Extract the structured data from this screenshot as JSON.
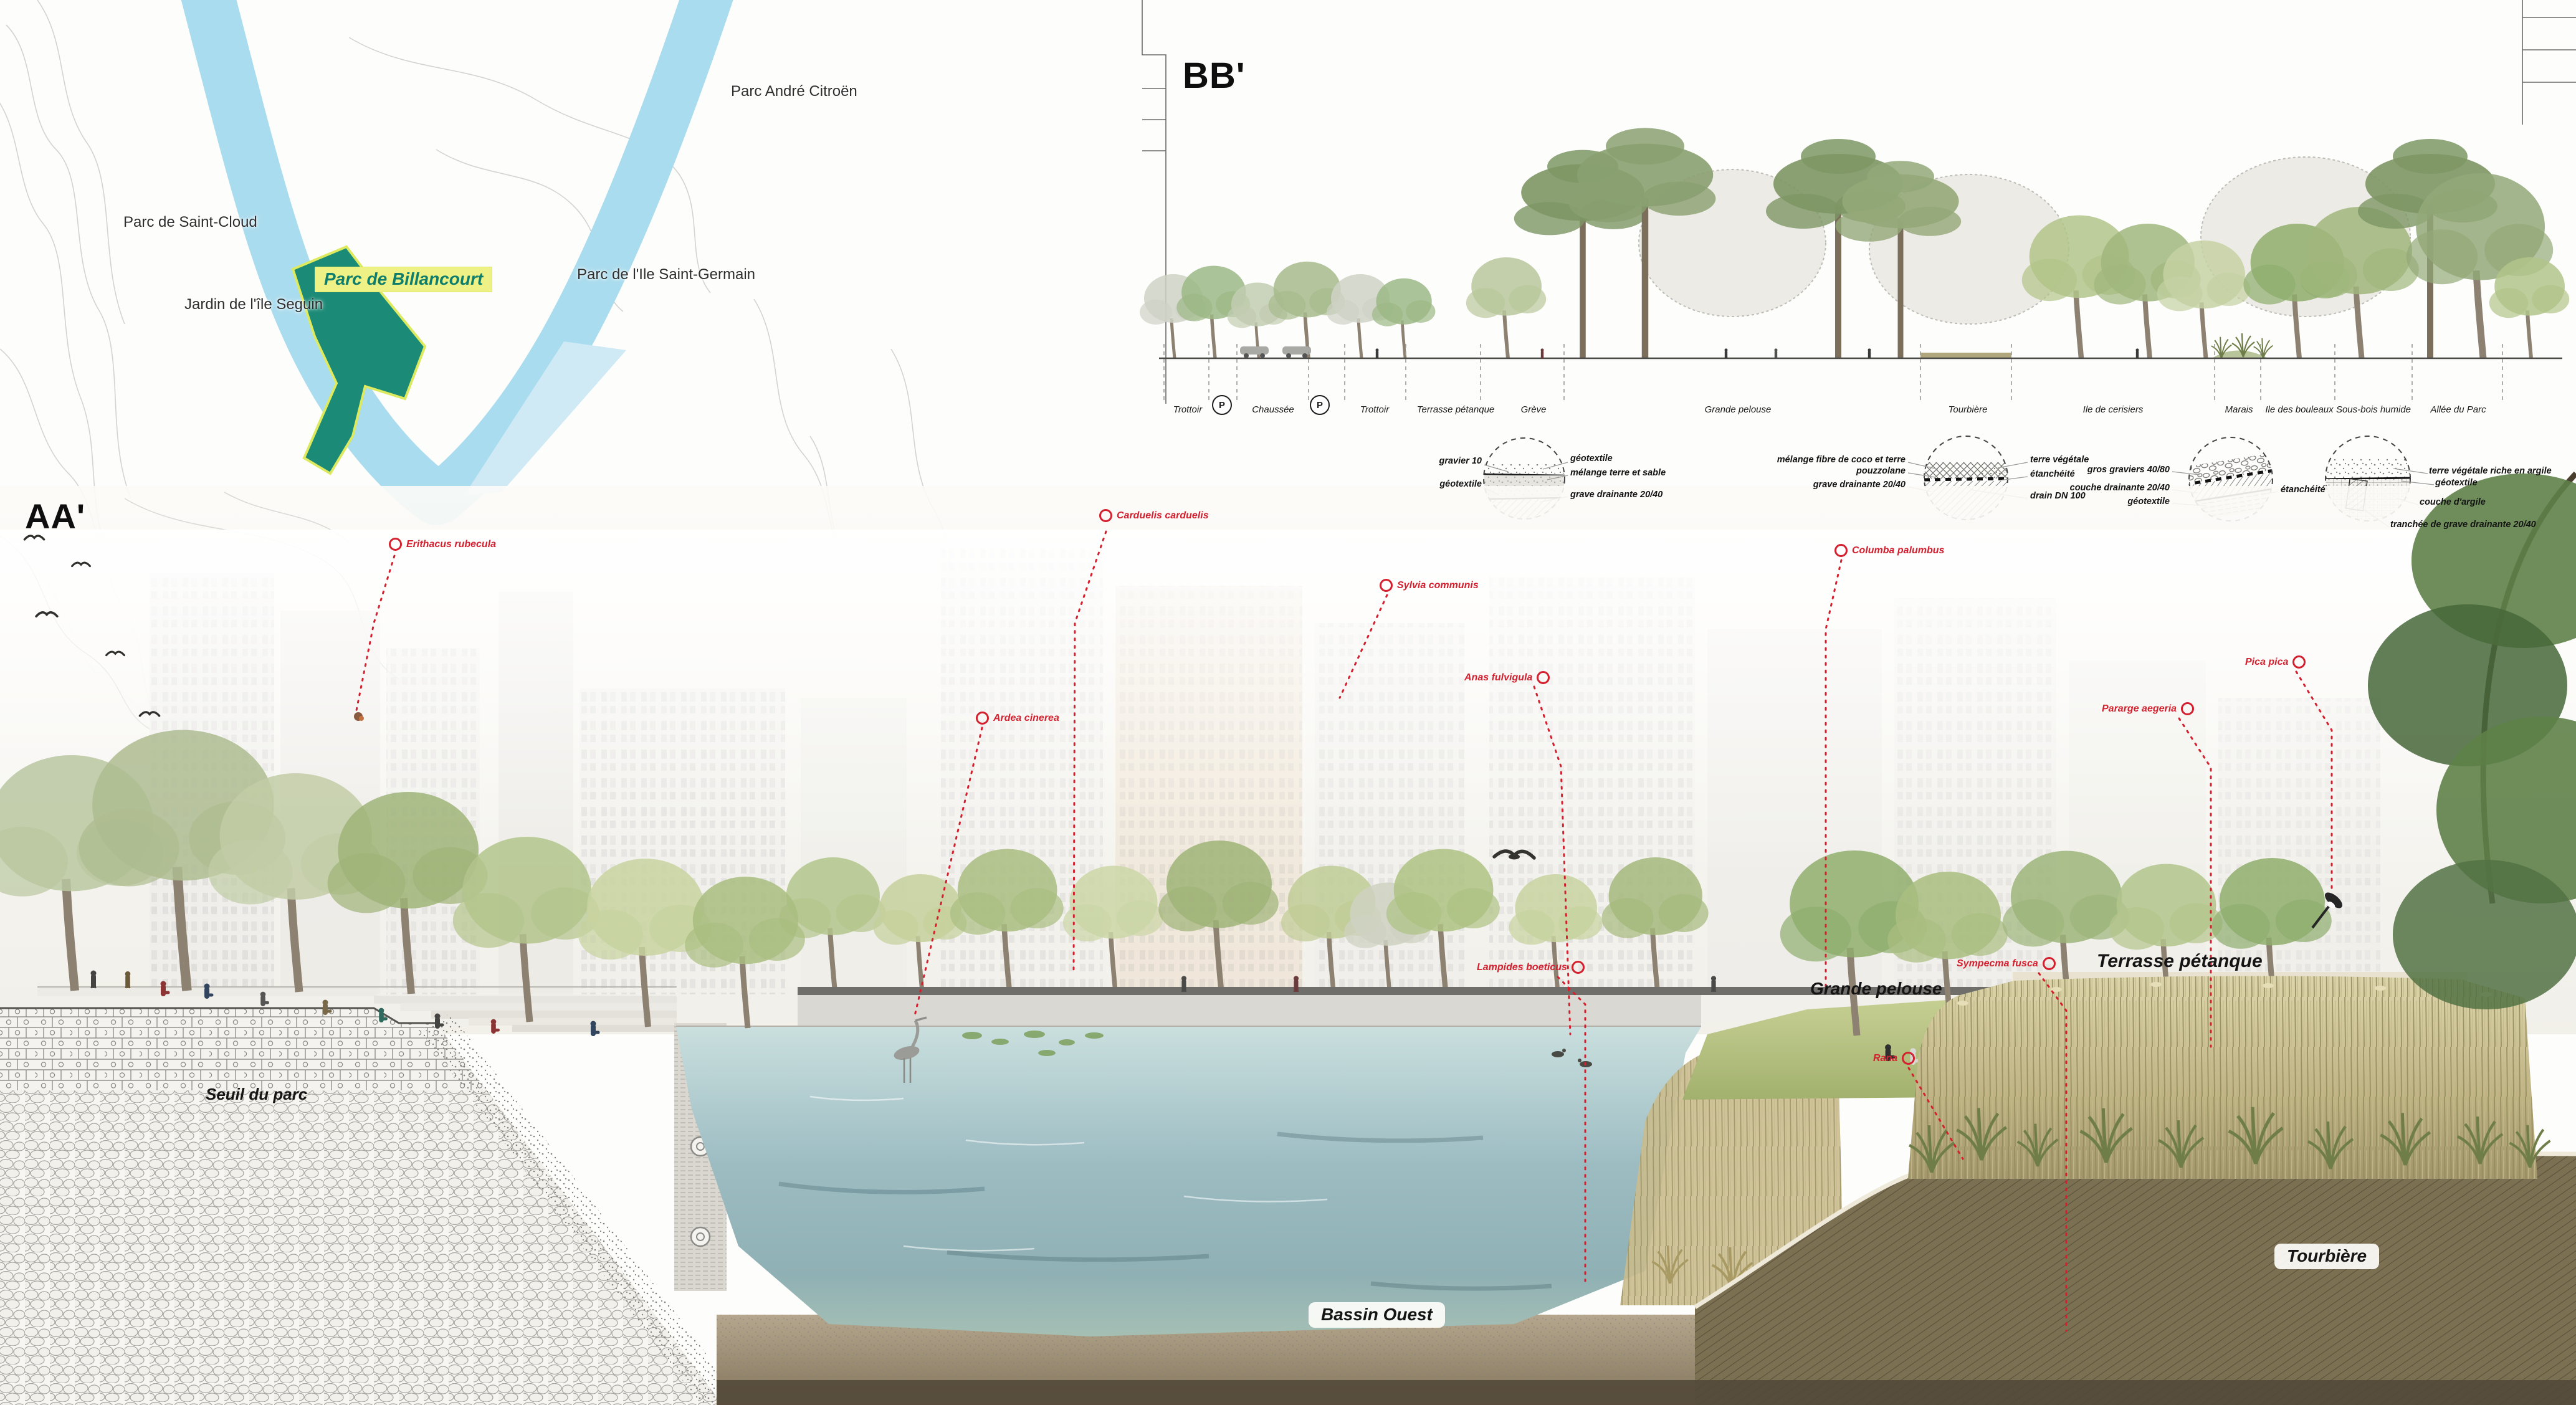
{
  "map": {
    "labels": [
      {
        "text": "Parc André Citroën"
      },
      {
        "text": "Parc de Saint-Cloud"
      },
      {
        "text": "Jardin de l'île Seguin"
      },
      {
        "text": "Parc de l'Ile Saint-Germain"
      }
    ],
    "highlight": {
      "text": "Parc de Billancourt"
    },
    "colors": {
      "river": "#a9dcee",
      "parcel": "#1b8a76",
      "highlight_bg": "#eef286",
      "highlight_text": "#0e7d6b"
    }
  },
  "section_bb": {
    "title": "BB'",
    "parking_badge": "P",
    "zones": [
      {
        "label": "Trottoir"
      },
      {
        "label": "Chaussée"
      },
      {
        "label": "Trottoir"
      },
      {
        "label": "Terrasse pétanque"
      },
      {
        "label": "Grève"
      },
      {
        "label": "Grande pelouse"
      },
      {
        "label": "Tourbière"
      },
      {
        "label": "Ile de cerisiers"
      },
      {
        "label": "Marais"
      },
      {
        "label": "Ile des bouleaux"
      },
      {
        "label": "Sous-bois humide"
      },
      {
        "label": "Allée du Parc"
      }
    ],
    "detail_labels": [
      {
        "text": "gravier 10"
      },
      {
        "text": "géotextile"
      },
      {
        "text": "géotextile"
      },
      {
        "text": "mélange terre et sable"
      },
      {
        "text": "grave drainante 20/40"
      },
      {
        "text": "mélange fibre de coco et terre"
      },
      {
        "text": "pouzzolane"
      },
      {
        "text": "grave drainante 20/40"
      },
      {
        "text": "terre végétale"
      },
      {
        "text": "étanchéité"
      },
      {
        "text": "drain DN 100"
      },
      {
        "text": "gros graviers 40/80"
      },
      {
        "text": "couche drainante 20/40"
      },
      {
        "text": "géotextile"
      },
      {
        "text": "étanchéité"
      },
      {
        "text": "terre végétale riche en argile"
      },
      {
        "text": "géotextile"
      },
      {
        "text": "couche d'argile"
      },
      {
        "text": "tranchée de grave drainante 20/40"
      }
    ]
  },
  "section_aa": {
    "title": "AA'",
    "accent_color": "#d4202e",
    "species_labels": [
      {
        "text": "Erithacus rubecula"
      },
      {
        "text": "Carduelis carduelis"
      },
      {
        "text": "Sylvia communis"
      },
      {
        "text": "Columba palumbus"
      },
      {
        "text": "Anas fulvigula"
      },
      {
        "text": "Ardea cinerea"
      },
      {
        "text": "Lampides boeticus"
      },
      {
        "text": "Sympecma fusca"
      },
      {
        "text": "Rana"
      },
      {
        "text": "Pararge aegeria"
      },
      {
        "text": "Pica pica"
      }
    ],
    "place_labels": [
      {
        "text": "Seuil du parc"
      },
      {
        "text": "Grande pelouse"
      },
      {
        "text": "Terrasse pétanque"
      },
      {
        "text": "Bassin Ouest"
      },
      {
        "text": "Tourbière"
      }
    ]
  }
}
